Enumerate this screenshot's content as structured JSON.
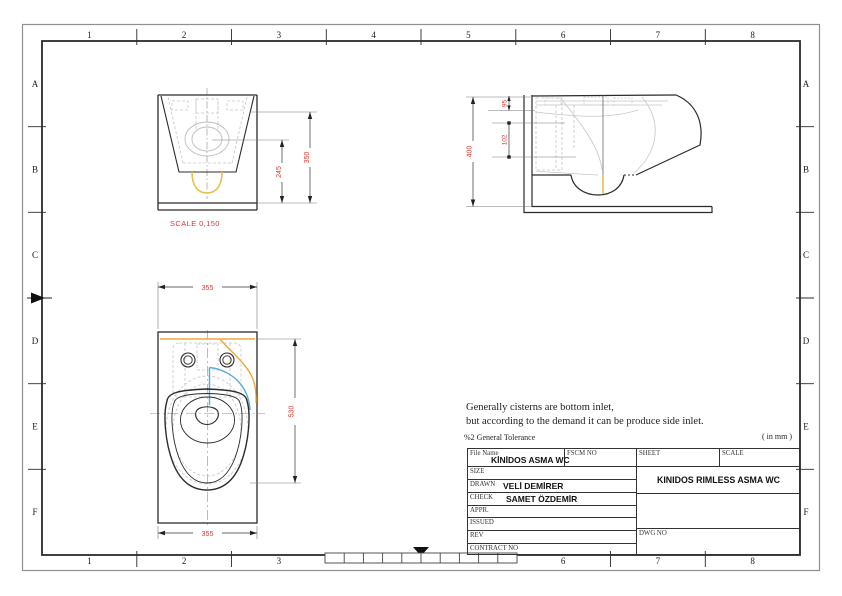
{
  "drawing": {
    "grid": {
      "columns": [
        "1",
        "2",
        "3",
        "4",
        "5",
        "6",
        "7",
        "8"
      ],
      "rows": [
        "A",
        "B",
        "C",
        "D",
        "E",
        "F"
      ]
    },
    "front_view": {
      "dim_overall_height": "350",
      "dim_rim_height": "245",
      "scale_note": "SCALE  0,150"
    },
    "side_view": {
      "dim_overall": "400",
      "dim_top_offset": "95",
      "dim_inlet": "102"
    },
    "plan_view": {
      "dim_width_top": "355",
      "dim_depth": "530",
      "dim_width_bottom": "355"
    },
    "notes": {
      "line1": "Generally cisterns are bottom inlet,",
      "line2": "but according to  the demand it can be produce side inlet.",
      "tolerance": "%2 General Tolerance",
      "units": "( in mm )"
    },
    "title_block": {
      "file_name_label": "File Name",
      "file_name": "KİNİDOS ASMA WC",
      "fscm_no_label": "FSCM NO",
      "sheet_label": "SHEET",
      "scale_label": "SCALE",
      "size_label": "SIZE",
      "drawn_label": "DRAWN",
      "drawn": "VELİ DEMİRER",
      "check_label": "CHECK",
      "check": "SAMET ÖZDEMİR",
      "appr_label": "APPR.",
      "issued_label": "ISSUED",
      "rev_label": "REV",
      "contract_no_label": "CONTRACT NO",
      "dwg_no_label": "DWG NO",
      "drawing_title": "KINIDOS RIMLESS ASMA WC"
    },
    "colors": {
      "dimension_red": "#dd3a32",
      "supply_orange": "#f0a73c",
      "supply_blue": "#57aadb",
      "trap_yellow": "#e9c04a",
      "outline": "#2b2b2b"
    }
  }
}
